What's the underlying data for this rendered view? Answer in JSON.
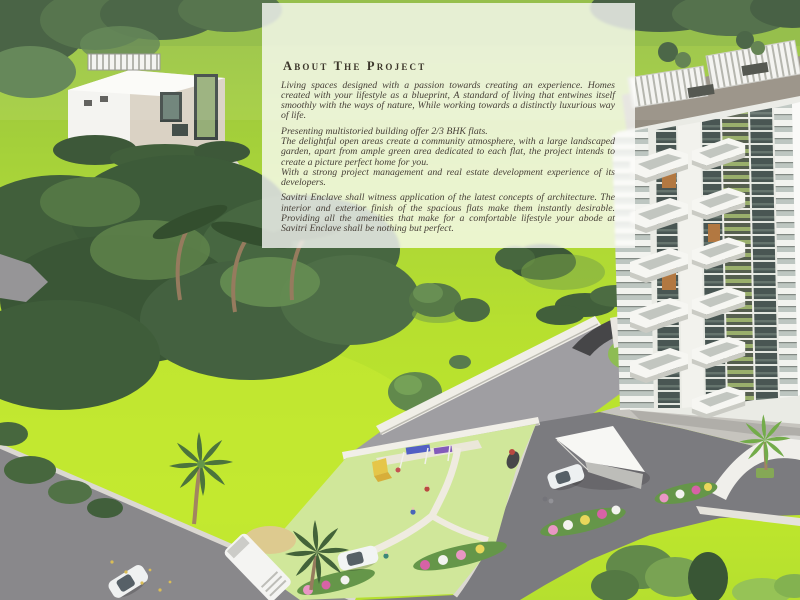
{
  "panel": {
    "heading": "About The Project",
    "paragraphs": [
      "Living spaces designed with a passion towards creating an experience. Homes created with your lifestyle as a blueprint, A standard of living that entwines itself smoothly with the ways of nature, While working towards a distinctly luxurious way of life.",
      "Presenting multistoried building offer 2/3 BHK flats.",
      "The delightful open areas create a community atmosphere, with a large landscaped garden, apart from ample green area dedicated to each flat, the project intends to create a picture perfect home for you.",
      "With a strong project management and real estate development experience of its developers.",
      "Savitri Enclave shall witness application of the latest concepts of architecture. The interior and exterior finish of the spacious flats make them instantly desirable. Providing all the amenities that make for a comfortable lifestyle your abode at Savitri Enclave shall be nothing but perfect."
    ]
  },
  "colors": {
    "lawn": "#b2de20",
    "foliage_dark": "#2f4f2a",
    "road": "#7d7c80",
    "building_white": "#f2f1ed",
    "glass": "#3c4a46",
    "accent_wood": "#ad6e33",
    "panel_background": "#fdfdfa",
    "panel_text": "#474038"
  }
}
